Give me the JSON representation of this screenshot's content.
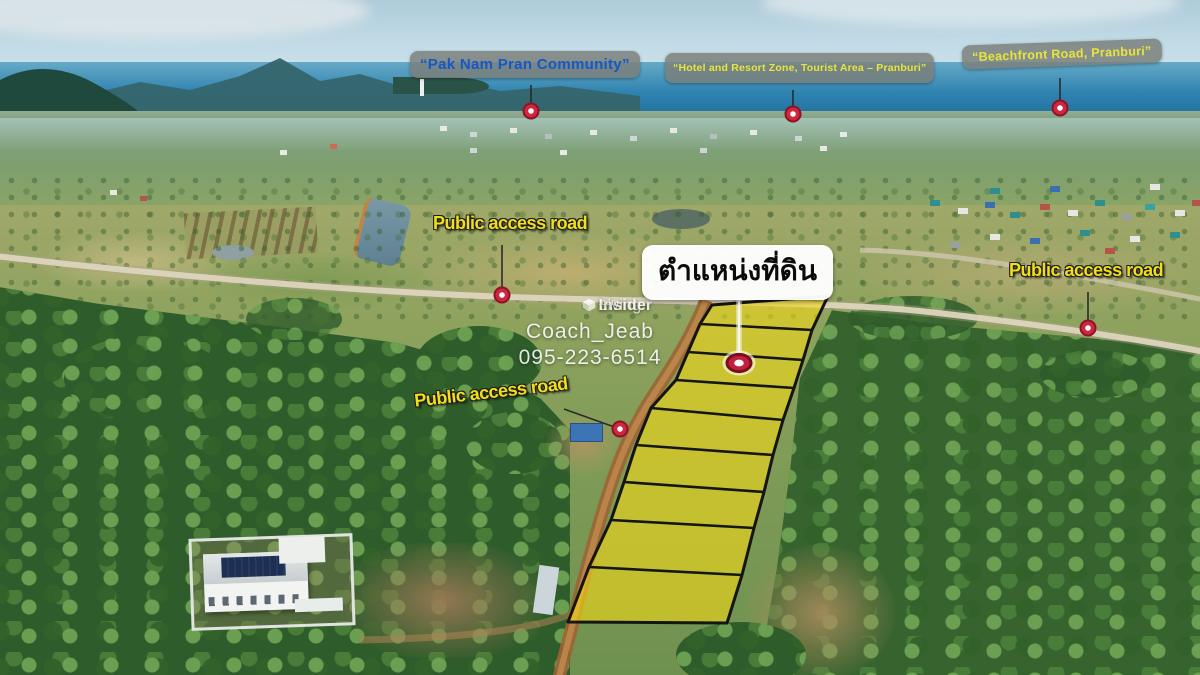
{
  "callouts": {
    "pak_nam": {
      "text": "“Pak Nam Pran Community”"
    },
    "hotel_zone": {
      "text": "“Hotel and Resort Zone, Tourist Area – Pranburi”"
    },
    "beachfront": {
      "text": "“Beachfront Road, Pranburi”"
    },
    "road_top": {
      "text": "Public access road"
    },
    "road_right": {
      "text": "Public access road"
    },
    "road_mid": {
      "text": "Public access road"
    },
    "land_position": {
      "text": "ตำแหน่งที่ดิน"
    }
  },
  "watermark": {
    "brand_prefix": "Living",
    "brand_bold": "Insider",
    "brand_tld": ".com",
    "agent": "Coach_Jeab",
    "phone": "095-223-6514"
  },
  "land_plot": {
    "parcel_count": 9,
    "fill": "rgba(250,221,20,0.58)",
    "stroke": "#151515",
    "left_edge": [
      [
        712,
        305
      ],
      [
        700,
        324
      ],
      [
        688,
        352
      ],
      [
        676,
        380
      ],
      [
        651,
        408
      ],
      [
        636,
        445
      ],
      [
        624,
        482
      ],
      [
        611,
        520
      ],
      [
        589,
        567
      ],
      [
        568,
        622
      ]
    ],
    "right_edge": [
      [
        828,
        296
      ],
      [
        812,
        330
      ],
      [
        803,
        360
      ],
      [
        794,
        388
      ],
      [
        783,
        420
      ],
      [
        773,
        455
      ],
      [
        764,
        492
      ],
      [
        754,
        528
      ],
      [
        742,
        575
      ],
      [
        727,
        623
      ]
    ]
  },
  "pins": [
    {
      "id": "pin-pak-nam-community",
      "kind": "dot",
      "x": 531,
      "y": 111,
      "line": [
        531,
        85
      ]
    },
    {
      "id": "pin-hotel-resort-zone",
      "kind": "dot",
      "x": 793,
      "y": 114,
      "line": [
        793,
        90
      ]
    },
    {
      "id": "pin-beachfront-road",
      "kind": "dot",
      "x": 1060,
      "y": 108,
      "line": [
        1060,
        78
      ]
    },
    {
      "id": "pin-road-top",
      "kind": "dot",
      "x": 502,
      "y": 295,
      "line": [
        502,
        245
      ]
    },
    {
      "id": "pin-road-right",
      "kind": "dot",
      "x": 1088,
      "y": 328,
      "line": [
        1088,
        292
      ]
    },
    {
      "id": "pin-road-mid",
      "kind": "dot",
      "x": 620,
      "y": 429,
      "line": [
        564,
        409
      ]
    },
    {
      "id": "pin-land-position",
      "kind": "target",
      "x": 739,
      "y": 363,
      "line": [
        739,
        298
      ]
    }
  ],
  "colors": {
    "pin_red": "#cd2840",
    "pin_red_dark": "#8c1322",
    "target_red": "#c51f3e",
    "target_red_dark": "#75101f",
    "road_label_yellow": "#f2df1b",
    "callout_yellow": "#e9e43c",
    "callout_blue": "#1757c6",
    "plot_yellow": "rgba(250,221,20,0.58)"
  }
}
